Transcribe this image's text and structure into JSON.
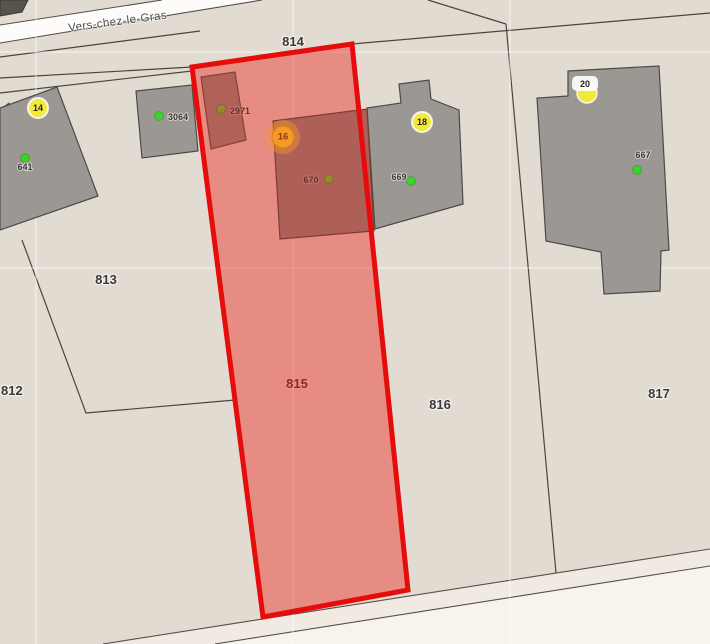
{
  "map": {
    "street": {
      "name": "Vers-chez-le-Gras"
    },
    "parcels": {
      "p812": "812",
      "p813": "813",
      "p814": "814",
      "p815": "815",
      "p816": "816",
      "p817": "817"
    },
    "buildings": {
      "b641": "641",
      "b3064": "3064",
      "b2971": "2971",
      "b670": "670",
      "b669": "669",
      "b667": "667"
    },
    "markers": {
      "m14": "14",
      "m16": "16",
      "m18": "18",
      "m20": "20"
    },
    "selection": {
      "selected_parcel": "815",
      "border_color": "#e60c0c",
      "fill_color": "rgba(235,45,35,0.45)"
    },
    "colors": {
      "background": "#e2dbd2",
      "road": "#fdfcfa",
      "building_gray": "#9b9893",
      "building_selected_tint": "#ad5f58",
      "marker_yellow": "#f5e83d",
      "marker_orange": "#f59a28",
      "dot_green": "#3ed02b",
      "dot_olive": "#938a2b",
      "boundary_line": "#4a453e"
    }
  }
}
